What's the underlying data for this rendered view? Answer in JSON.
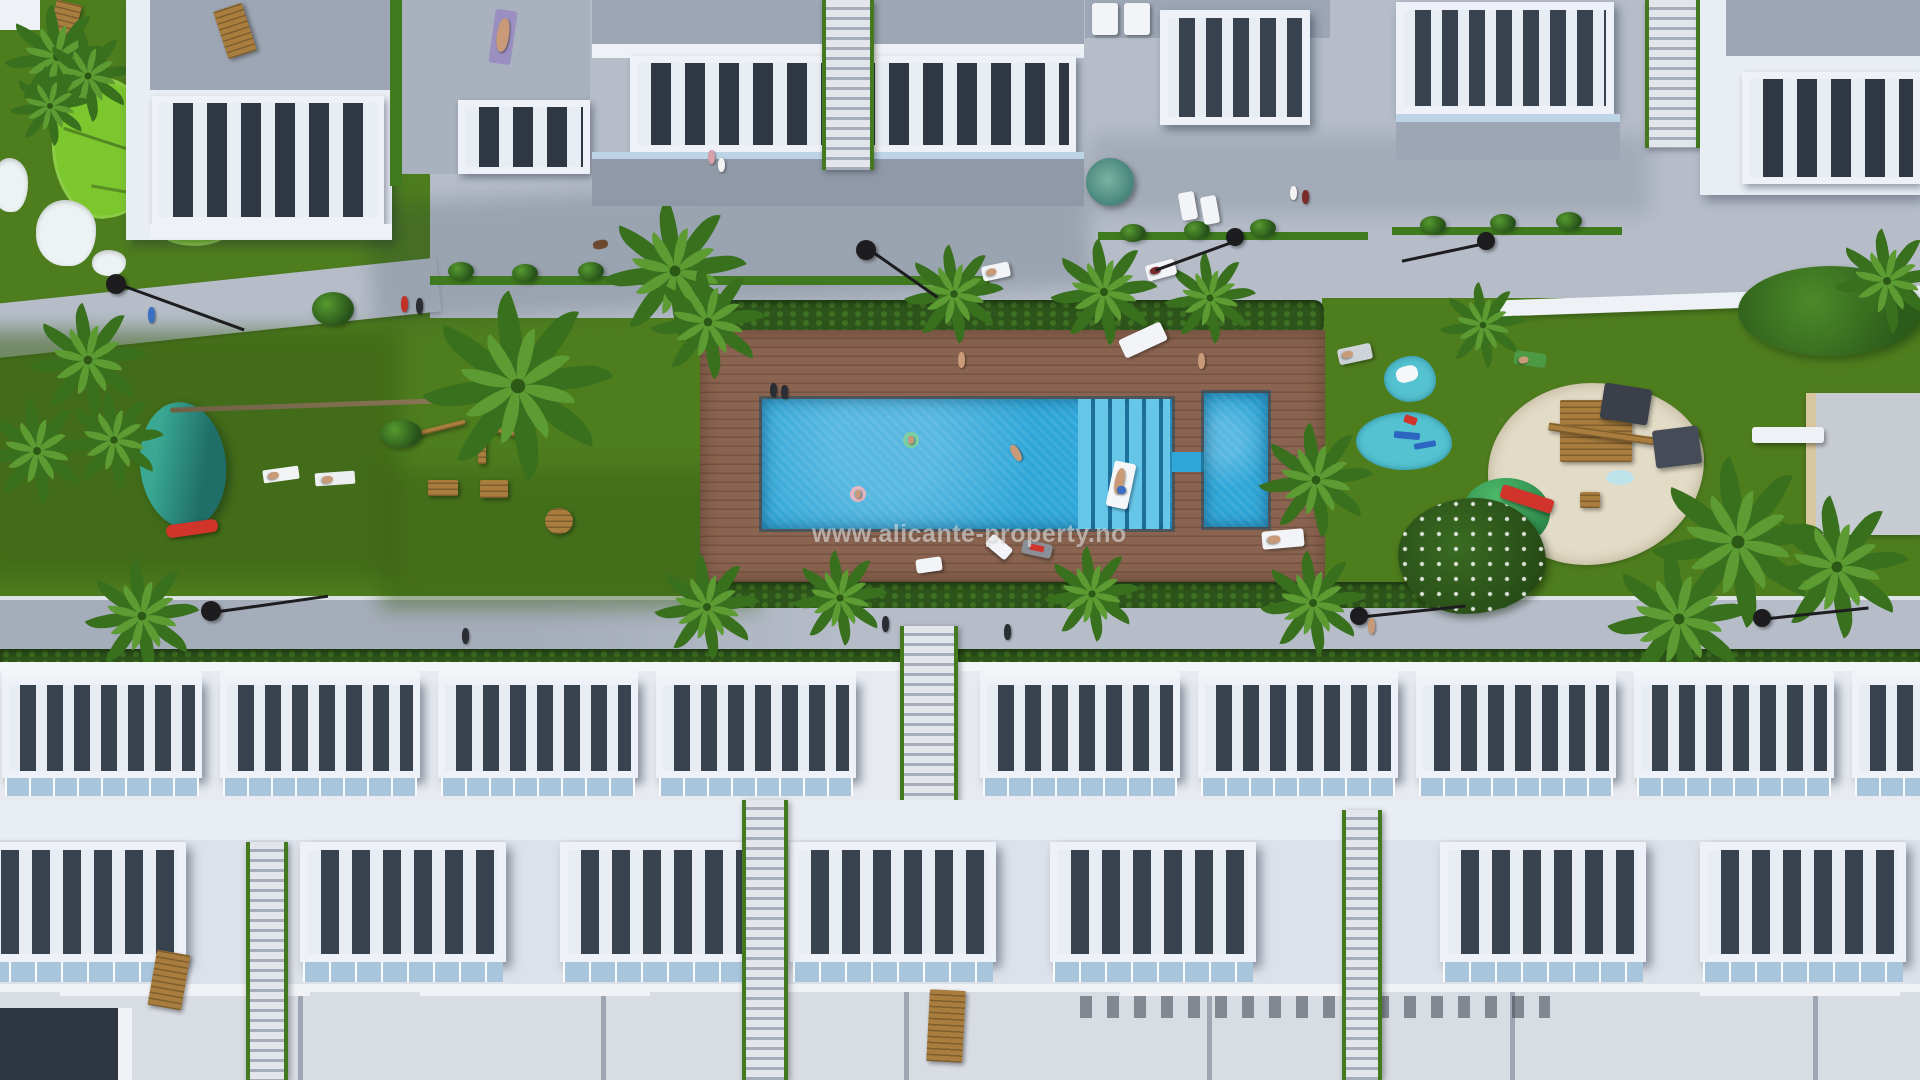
{
  "watermark": {
    "text": "www.alicante-property.no"
  },
  "scene": {
    "colors": {
      "grass": "#4e7d1e",
      "grassDark": "#3a5f16",
      "grassBright": "#5d9422",
      "putting": "#7dc72e",
      "bunker": "#edf2f4",
      "walkway": "#b6bdc9",
      "walkwayShade": "#99a1b0",
      "deck": "#8a6450",
      "pool": "#2ea6d8",
      "poolLight": "#66c6e8",
      "splash": "#54c2d0",
      "teal": "#2f9587",
      "sand": "#e2dbc6",
      "building": "#e9edf4",
      "buildingShade": "#c5cdda",
      "roof": "#9ca6b4",
      "roofLight": "#d8dce3",
      "terrace": "#39424f",
      "glass": "#a9c5dc",
      "hedge": "#2d541a",
      "palm": "#417f24",
      "lamp": "#1d1d1f",
      "wood": "#a97d3e",
      "accentRed": "#d0342b",
      "watermarkColor": "rgba(255,255,255,0.5)"
    }
  }
}
